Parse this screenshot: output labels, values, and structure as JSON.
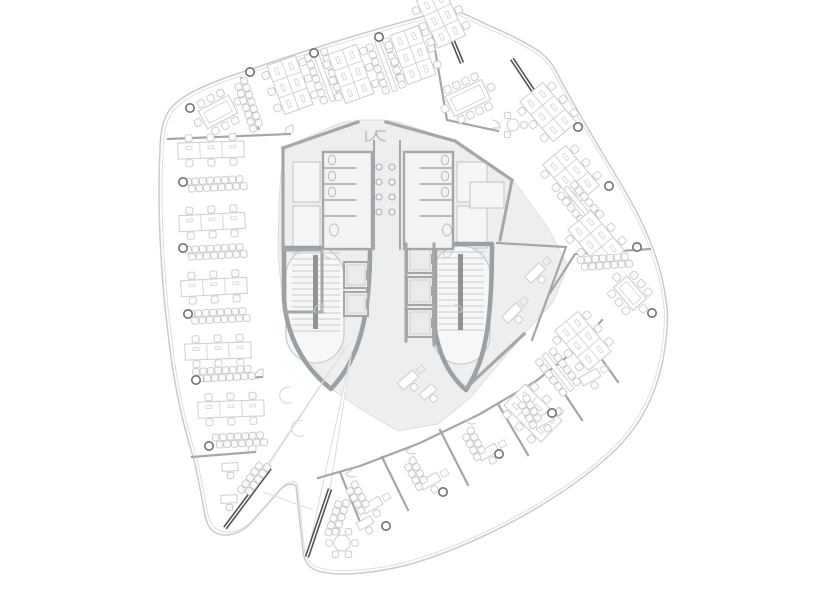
{
  "meta": {
    "title": "Office tower floor plan",
    "drawing_type": "architectural-plan"
  },
  "canvas": {
    "w": 818,
    "h": 591,
    "bg": "#ffffff"
  },
  "palette": {
    "line": "#c9ccce",
    "lighter": "#dcdfe1",
    "furniture": "#cbcfd2",
    "chair": "#c6cacd",
    "wall": "#a3a7aa",
    "wall_strong": "#9aa0a3",
    "core_fill": "#edeef0",
    "elev_fill": "#e9ebec",
    "glass_dark": "#4f5458",
    "column": "#6e7377",
    "stringer": "#8f9396",
    "tread": "#c7cacc",
    "void_stroke": "#dadcde",
    "fixture": "#b9bdc0",
    "sink": "#a9adb0",
    "bg": "#ffffff"
  },
  "plan": {
    "boundary": {
      "outer": "M452,9 C390,24 300,52 252,69 C216,80 184,93 172,107 C163,117 160,132 160,152 C157,205 161,282 169,341 C173,377 181,418 192,453 C197,469 201,495 205,515 C207,526 212,534 223,535 C232,536 243,531 250,524 L281,489 C286,484 291,482 296,486 L303,551 C304,562 310,570 322,572 C345,577 390,572 430,558 C490,537 560,500 610,455 C640,428 660,392 666,340 C668,322 668,310 666,300 C661,262 646,228 628,196 C606,158 577,112 558,75 C553,64 546,55 534,48 C522,41 505,32 490,26 C477,20 462,12 452,9 Z",
      "inner_scale": 0.988,
      "notch_line": [
        [
          263,
          492
        ],
        [
          313,
          510
        ]
      ]
    },
    "core": {
      "fill": [
        [
          283,
          148
        ],
        [
          340,
          123
        ],
        [
          360,
          120
        ],
        [
          385,
          120
        ],
        [
          398,
          122
        ],
        [
          455,
          141
        ],
        [
          513,
          180
        ],
        [
          548,
          228
        ],
        [
          568,
          266
        ],
        [
          553,
          302
        ],
        [
          525,
          333
        ],
        [
          470,
          398
        ],
        [
          438,
          424
        ],
        [
          398,
          431
        ],
        [
          362,
          410
        ],
        [
          330,
          388
        ],
        [
          305,
          355
        ],
        [
          283,
          305
        ],
        [
          278,
          255
        ],
        [
          279,
          200
        ]
      ],
      "hulls": [
        "M284,248 L284,300 C288,345 310,372 331,389 C352,366 370,334 370,250 L370,248 Z",
        "M435,244 L435,330 C440,360 452,378 466,390 C484,362 492,330 492,244 Z"
      ],
      "stairs": [
        {
          "x": 292,
          "y": 253,
          "w": 48,
          "h": 78,
          "stringer": [
            313,
            255,
            5,
            74
          ],
          "oval": [
            286,
            247,
            58,
            116
          ]
        },
        {
          "x": 438,
          "y": 252,
          "w": 46,
          "h": 80,
          "stringer": [
            458,
            254,
            5,
            76
          ],
          "oval": [
            432,
            246,
            58,
            118
          ]
        }
      ],
      "elevators": [
        [
          344,
          262,
          24,
          26
        ],
        [
          344,
          292,
          24,
          24
        ],
        [
          407,
          245,
          26,
          28
        ],
        [
          407,
          277,
          26,
          28
        ],
        [
          407,
          309,
          26,
          28
        ]
      ],
      "rooms": [
        [
          293,
          162,
          27,
          40
        ],
        [
          293,
          206,
          27,
          42
        ],
        [
          457,
          162,
          30,
          40
        ],
        [
          457,
          206,
          30,
          42
        ],
        [
          286,
          314,
          36,
          24
        ],
        [
          470,
          182,
          34,
          26
        ]
      ],
      "toilets": [
        {
          "rect": [
            323,
            152,
            49,
            97
          ],
          "div_x": [
            323,
            356
          ],
          "div_y": [
            168,
            184,
            200,
            216
          ],
          "fix_x": 332
        },
        {
          "rect": [
            404,
            152,
            49,
            97
          ],
          "div_x": [
            420,
            453
          ],
          "div_y": [
            168,
            184,
            200,
            216
          ],
          "fix_x": 445
        }
      ],
      "shaft_lines": [
        [
          [
            374,
            140
          ],
          [
            374,
            250
          ]
        ],
        [
          [
            400,
            140
          ],
          [
            400,
            250
          ]
        ]
      ],
      "sinks": {
        "xs": [
          379,
          392
        ],
        "ys": [
          167,
          182,
          197,
          212
        ],
        "r": 3
      },
      "entry_arcs": [
        {
          "c": [
            366,
            131
          ],
          "r": 10,
          "rot": 0
        },
        {
          "c": [
            386,
            131
          ],
          "r": 10,
          "rot": 90
        }
      ],
      "c_curves": [
        [
          285,
          395
        ],
        [
          297,
          428
        ]
      ]
    },
    "voids": [
      [
        [
          348,
          344
        ],
        [
          225,
          528
        ],
        [
          268,
          466
        ]
      ],
      [
        [
          352,
          350
        ],
        [
          307,
          557
        ],
        [
          330,
          489
        ]
      ]
    ],
    "glass_walls": [
      {
        "a": [
          448,
          29
        ],
        "b": [
          462,
          63
        ]
      },
      {
        "a": [
          512,
          59
        ],
        "b": [
          534,
          92
        ]
      },
      {
        "a": [
          270,
          468
        ],
        "b": [
          225,
          528
        ]
      },
      {
        "a": [
          330,
          489
        ],
        "b": [
          307,
          557
        ]
      }
    ],
    "light_glass": [
      {
        "a": [
          241,
          77
        ],
        "b": [
          259,
          130
        ]
      }
    ],
    "walls": [
      {
        "pts": [
          [
            168,
            139
          ],
          [
            290,
            134
          ]
        ]
      },
      {
        "pts": [
          [
            197,
            381
          ],
          [
            262,
            377
          ]
        ]
      },
      {
        "pts": [
          [
            192,
            457
          ],
          [
            255,
            452
          ]
        ]
      },
      {
        "pts": [
          [
            432,
            32
          ],
          [
            447,
            120
          ],
          [
            498,
            131
          ]
        ]
      },
      {
        "pts": [
          [
            650,
            249
          ],
          [
            575,
            254
          ],
          [
            550,
            293
          ]
        ]
      },
      {
        "pts": [
          [
            497,
            243
          ],
          [
            566,
            247
          ],
          [
            532,
            340
          ]
        ]
      },
      {
        "pts": [
          [
            318,
            478
          ],
          [
            360,
            466
          ],
          [
            420,
            443
          ],
          [
            480,
            414
          ],
          [
            536,
            381
          ],
          [
            577,
            349
          ],
          [
            602,
            320
          ]
        ]
      },
      {
        "pts": [
          [
            340,
            472
          ],
          [
            362,
            527
          ]
        ]
      },
      {
        "pts": [
          [
            382,
            457
          ],
          [
            408,
            510
          ]
        ]
      },
      {
        "pts": [
          [
            440,
            430
          ],
          [
            468,
            485
          ]
        ]
      },
      {
        "pts": [
          [
            498,
            404
          ],
          [
            528,
            455
          ]
        ]
      },
      {
        "pts": [
          [
            550,
            372
          ],
          [
            582,
            420
          ]
        ]
      },
      {
        "pts": [
          [
            588,
            340
          ],
          [
            618,
            382
          ]
        ]
      },
      {
        "pts": [
          [
            283,
            148
          ],
          [
            358,
            122
          ]
        ],
        "w": 3.2
      },
      {
        "pts": [
          [
            386,
            122
          ],
          [
            455,
            141
          ],
          [
            512,
            180
          ]
        ],
        "w": 3.2
      },
      {
        "pts": [
          [
            283,
            148
          ],
          [
            283,
            250
          ]
        ],
        "w": 3.2
      },
      {
        "pts": [
          [
            512,
            180
          ],
          [
            500,
            240
          ]
        ],
        "w": 3
      },
      {
        "pts": [
          [
            283,
            250
          ],
          [
            322,
            250
          ]
        ],
        "w": 3
      },
      {
        "pts": [
          [
            322,
            250
          ],
          [
            322,
            312
          ]
        ],
        "w": 3
      },
      {
        "pts": [
          [
            286,
            312
          ],
          [
            322,
            312
          ]
        ],
        "w": 3
      },
      {
        "pts": [
          [
            466,
            388
          ],
          [
            524,
            334
          ]
        ],
        "w": 3.2
      },
      {
        "pts": [
          [
            406,
            244
          ],
          [
            406,
            341
          ]
        ],
        "w": 3
      },
      {
        "pts": [
          [
            434,
            244
          ],
          [
            434,
            345
          ]
        ],
        "w": 3
      }
    ],
    "door_arcs": [
      {
        "c": [
          293,
          133
        ],
        "r": 8,
        "rot": 180
      },
      {
        "c": [
          263,
          377
        ],
        "r": 8,
        "rot": 180
      },
      {
        "c": [
          256,
          451
        ],
        "r": 8,
        "rot": 180
      },
      {
        "c": [
          492,
          128
        ],
        "r": 8,
        "rot": -90
      },
      {
        "c": [
          352,
          470
        ],
        "r": 7,
        "rot": 60
      },
      {
        "c": [
          412,
          447
        ],
        "r": 7,
        "rot": 60
      },
      {
        "c": [
          472,
          417
        ],
        "r": 7,
        "rot": 60
      },
      {
        "c": [
          530,
          384
        ],
        "r": 7,
        "rot": 60
      },
      {
        "c": [
          330,
          250
        ],
        "r": 8,
        "rot": 90
      },
      {
        "c": [
          444,
          250
        ],
        "r": 8,
        "rot": 0
      },
      {
        "c": [
          322,
          312
        ],
        "r": 8,
        "rot": 180
      },
      {
        "c": [
          454,
          312
        ],
        "r": 8,
        "rot": -90
      }
    ],
    "columns": [
      [
        190,
        108
      ],
      [
        250,
        72
      ],
      [
        314,
        53
      ],
      [
        379,
        37
      ],
      [
        578,
        127
      ],
      [
        609,
        186
      ],
      [
        637,
        247
      ],
      [
        652,
        313
      ],
      [
        552,
        413
      ],
      [
        499,
        454
      ],
      [
        443,
        492
      ],
      [
        386,
        526
      ],
      [
        209,
        446
      ],
      [
        196,
        380
      ],
      [
        188,
        314
      ],
      [
        183,
        248
      ],
      [
        183,
        182
      ]
    ],
    "furniture": [
      {
        "t": "conf",
        "x": 218,
        "y": 112,
        "r": -28,
        "w": 34,
        "h": 20,
        "n": 8
      },
      {
        "t": "chairs",
        "x": 248,
        "y": 103,
        "r": 71,
        "n": 7
      },
      {
        "t": "benchh",
        "x": 211,
        "y": 150,
        "r": -2
      },
      {
        "t": "chairs",
        "x": 214,
        "y": 184,
        "r": -3,
        "n": 8
      },
      {
        "t": "benchh",
        "x": 212,
        "y": 222,
        "r": -3
      },
      {
        "t": "chairs",
        "x": 214,
        "y": 252,
        "r": -3,
        "n": 8
      },
      {
        "t": "benchh",
        "x": 214,
        "y": 287,
        "r": -3
      },
      {
        "t": "chairs",
        "x": 217,
        "y": 316,
        "r": -3,
        "n": 8
      },
      {
        "t": "benchh",
        "x": 218,
        "y": 351,
        "r": -2
      },
      {
        "t": "chairs",
        "x": 222,
        "y": 374,
        "r": -3,
        "n": 8
      },
      {
        "t": "benchh",
        "x": 231,
        "y": 409,
        "r": -2
      },
      {
        "t": "chairs",
        "x": 238,
        "y": 440,
        "r": -3,
        "n": 7
      },
      {
        "t": "sdesk",
        "x": 230,
        "y": 467,
        "r": -3
      },
      {
        "t": "sdesk",
        "x": 229,
        "y": 499,
        "r": -3
      },
      {
        "t": "bench3",
        "x": 290,
        "y": 85,
        "r": 70
      },
      {
        "t": "chairs2",
        "x": 324,
        "y": 76,
        "r": 70,
        "n": 7
      },
      {
        "t": "bench3",
        "x": 351,
        "y": 74,
        "r": 70
      },
      {
        "t": "chairs2",
        "x": 386,
        "y": 66,
        "r": 70,
        "n": 7
      },
      {
        "t": "bench3",
        "x": 413,
        "y": 55,
        "r": 70
      },
      {
        "t": "bench3",
        "x": 441,
        "y": 18,
        "r": 65
      },
      {
        "t": "conf",
        "x": 468,
        "y": 98,
        "r": -25,
        "w": 40,
        "h": 22,
        "n": 10
      },
      {
        "t": "rtable",
        "x": 513,
        "y": 125,
        "r": 0,
        "rad": 6,
        "n": 3
      },
      {
        "t": "bench3",
        "x": 548,
        "y": 112,
        "r": 50
      },
      {
        "t": "bench3",
        "x": 571,
        "y": 175,
        "r": 50
      },
      {
        "t": "chairs2",
        "x": 580,
        "y": 205,
        "r": 50,
        "n": 6
      },
      {
        "t": "bench3",
        "x": 596,
        "y": 240,
        "r": 50
      },
      {
        "t": "chairs",
        "x": 603,
        "y": 262,
        "r": -4,
        "n": 7
      },
      {
        "t": "conf",
        "x": 630,
        "y": 293,
        "r": 50,
        "w": 30,
        "h": 18,
        "n": 8
      },
      {
        "t": "bench3",
        "x": 583,
        "y": 341,
        "r": 50
      },
      {
        "t": "chairs2",
        "x": 558,
        "y": 372,
        "r": 52,
        "n": 6
      },
      {
        "t": "bench3",
        "x": 533,
        "y": 413,
        "r": 45
      },
      {
        "t": "desk",
        "x": 535,
        "y": 273,
        "r": -45
      },
      {
        "t": "desk",
        "x": 512,
        "y": 313,
        "r": -45
      },
      {
        "t": "desk",
        "x": 408,
        "y": 380,
        "r": -40
      },
      {
        "t": "sdesk",
        "x": 428,
        "y": 392,
        "r": -40
      },
      {
        "t": "desk",
        "x": 372,
        "y": 505,
        "r": -29
      },
      {
        "t": "desk",
        "x": 430,
        "y": 481,
        "r": -29
      },
      {
        "t": "desk",
        "x": 488,
        "y": 452,
        "r": -29
      },
      {
        "t": "desk",
        "x": 543,
        "y": 420,
        "r": -29
      },
      {
        "t": "desk",
        "x": 590,
        "y": 377,
        "r": -29
      },
      {
        "t": "chairs",
        "x": 357,
        "y": 496,
        "r": 61,
        "n": 4
      },
      {
        "t": "chairs",
        "x": 415,
        "y": 472,
        "r": 61,
        "n": 4
      },
      {
        "t": "chairs",
        "x": 473,
        "y": 442,
        "r": 61,
        "n": 4
      },
      {
        "t": "chairs",
        "x": 529,
        "y": 410,
        "r": 61,
        "n": 4
      },
      {
        "t": "chairs",
        "x": 253,
        "y": 480,
        "r": -53,
        "n": 5
      },
      {
        "t": "chairs",
        "x": 338,
        "y": 516,
        "r": 109,
        "n": 5
      },
      {
        "t": "rtable",
        "x": 342,
        "y": 543,
        "r": 0,
        "rad": 8,
        "n": 6
      },
      {
        "t": "sdesk",
        "x": 365,
        "y": 523,
        "r": -29
      }
    ]
  }
}
